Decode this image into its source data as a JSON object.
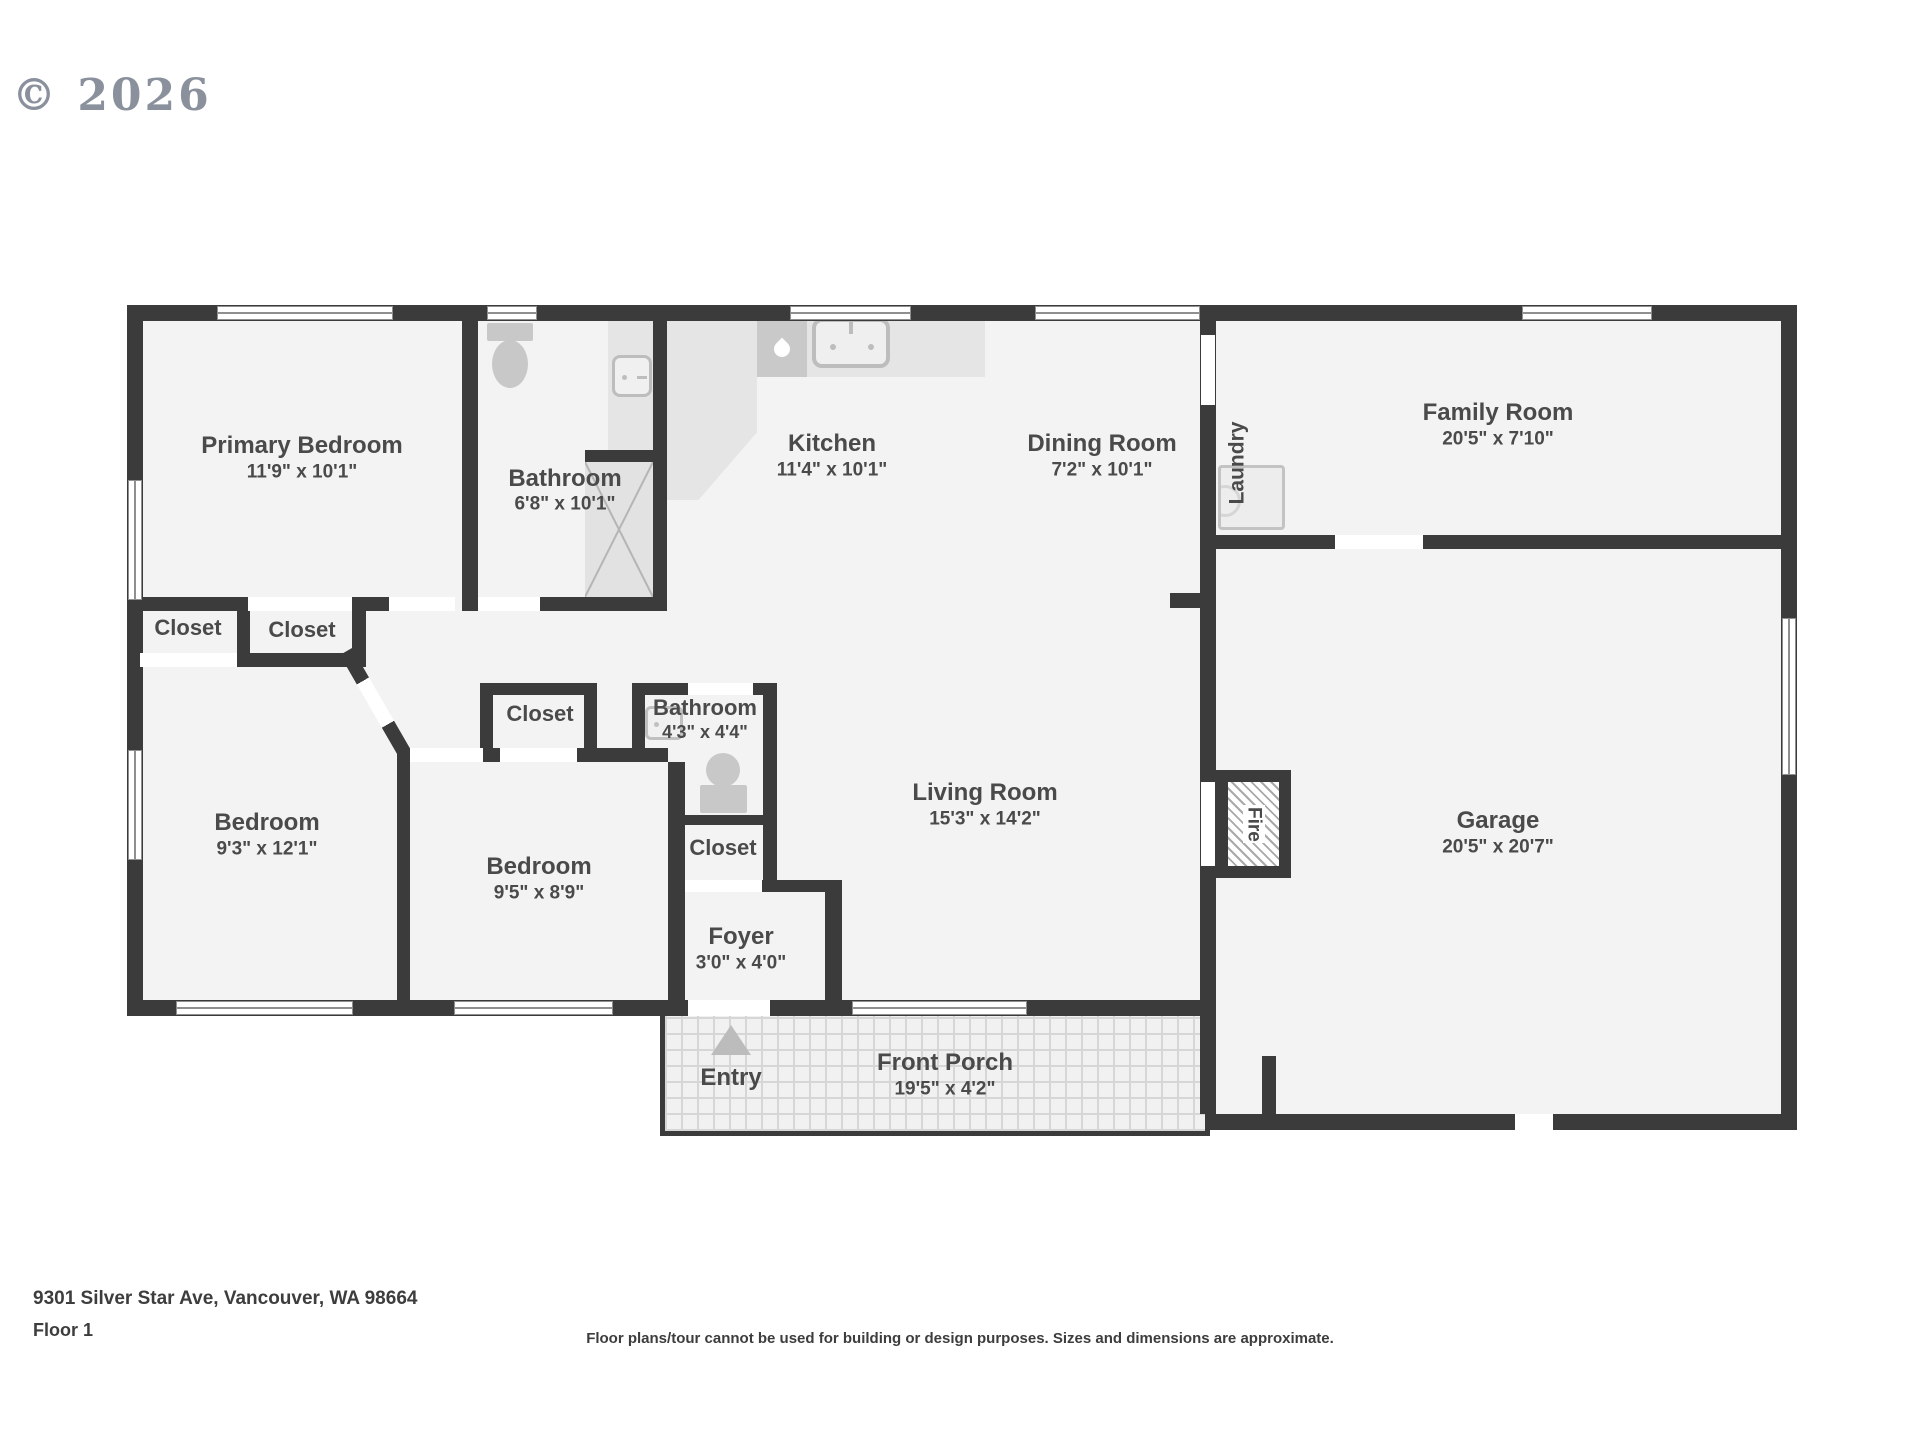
{
  "watermark": "© 2026",
  "rooms": {
    "primary_bedroom": {
      "name": "Primary Bedroom",
      "dims": "11'9\" x 10'1\""
    },
    "bathroom_main": {
      "name": "Bathroom",
      "dims": "6'8\" x 10'1\""
    },
    "kitchen": {
      "name": "Kitchen",
      "dims": "11'4\" x 10'1\""
    },
    "dining_room": {
      "name": "Dining Room",
      "dims": "7'2\" x 10'1\""
    },
    "family_room": {
      "name": "Family Room",
      "dims": "20'5\" x 7'10\""
    },
    "laundry": {
      "name": "Laundry"
    },
    "bedroom_left": {
      "name": "Bedroom",
      "dims": "9'3\" x 12'1\""
    },
    "bedroom_middle": {
      "name": "Bedroom",
      "dims": "9'5\" x 8'9\""
    },
    "bathroom_hall": {
      "name": "Bathroom",
      "dims": "4'3\" x 4'4\""
    },
    "living_room": {
      "name": "Living Room",
      "dims": "15'3\" x 14'2\""
    },
    "foyer": {
      "name": "Foyer",
      "dims": "3'0\" x 4'0\""
    },
    "garage": {
      "name": "Garage",
      "dims": "20'5\" x 20'7\""
    },
    "front_porch": {
      "name": "Front Porch",
      "dims": "19'5\" x 4'2\""
    },
    "closet": {
      "name": "Closet"
    },
    "fireplace": {
      "name": "Fire"
    },
    "entry": {
      "name": "Entry"
    }
  },
  "footer": {
    "address": "9301 Silver Star Ave, Vancouver, WA 98664",
    "floor": "Floor 1",
    "disclaimer": "Floor plans/tour cannot be used for building or design purposes. Sizes and dimensions are approximate."
  },
  "colors": {
    "wall": "#3b3b3b",
    "room_fill": "#f3f3f3",
    "fixture": "#c8c8c8",
    "counter": "#e5e5e5",
    "label_text": "#4a4a4a",
    "watermark": "#8a919d"
  }
}
